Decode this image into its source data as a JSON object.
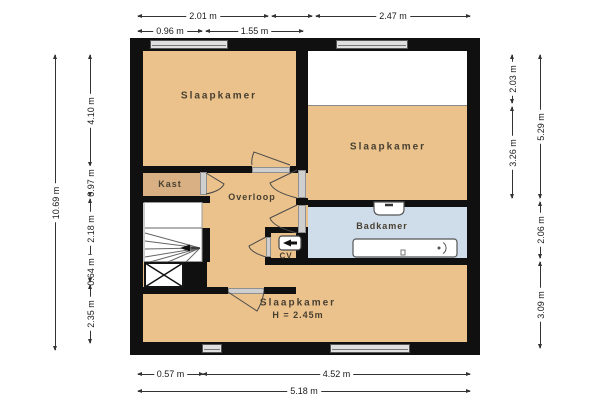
{
  "plan_type": "floorplan",
  "rooms": {
    "bedroom_top_left": {
      "label": "Slaapkamer"
    },
    "bedroom_right": {
      "label": "Slaapkamer"
    },
    "bedroom_bottom": {
      "label": "Slaapkamer",
      "height_note": "H = 2.45m"
    },
    "kast": {
      "label": "Kast"
    },
    "overloop": {
      "label": "Overloop"
    },
    "badkamer": {
      "label": "Badkamer"
    },
    "cv": {
      "label": "CV"
    }
  },
  "dimensions": {
    "top_row1_left": "2.01 m",
    "top_row1_right": "2.47 m",
    "top_row2_left": "0.96 m",
    "top_row2_right": "1.55 m",
    "bottom_row1_left": "0.57 m",
    "bottom_row1_right": "4.52 m",
    "bottom_row2": "5.18 m",
    "left_outer": "10.69 m",
    "left_inner": [
      "4.10 m",
      "0.97 m",
      "2.18 m",
      "0.64 m",
      "2.35 m"
    ],
    "right_inner": [
      "2.03 m",
      "3.26 m"
    ],
    "right_outer": [
      "5.29 m",
      "2.06 m",
      "3.09 m"
    ]
  },
  "fixtures": [
    "bathtub",
    "sink",
    "cv-boiler",
    "staircase",
    "void-cross"
  ],
  "colors": {
    "room_fill": "#ebc28b",
    "closet_fill": "#d8b083",
    "bathroom_fill": "#cfdce9",
    "wall": "#101010",
    "window_fill": "#e0e0e0",
    "dimension_text": "#1a1a1a",
    "label_text": "#473f31"
  }
}
